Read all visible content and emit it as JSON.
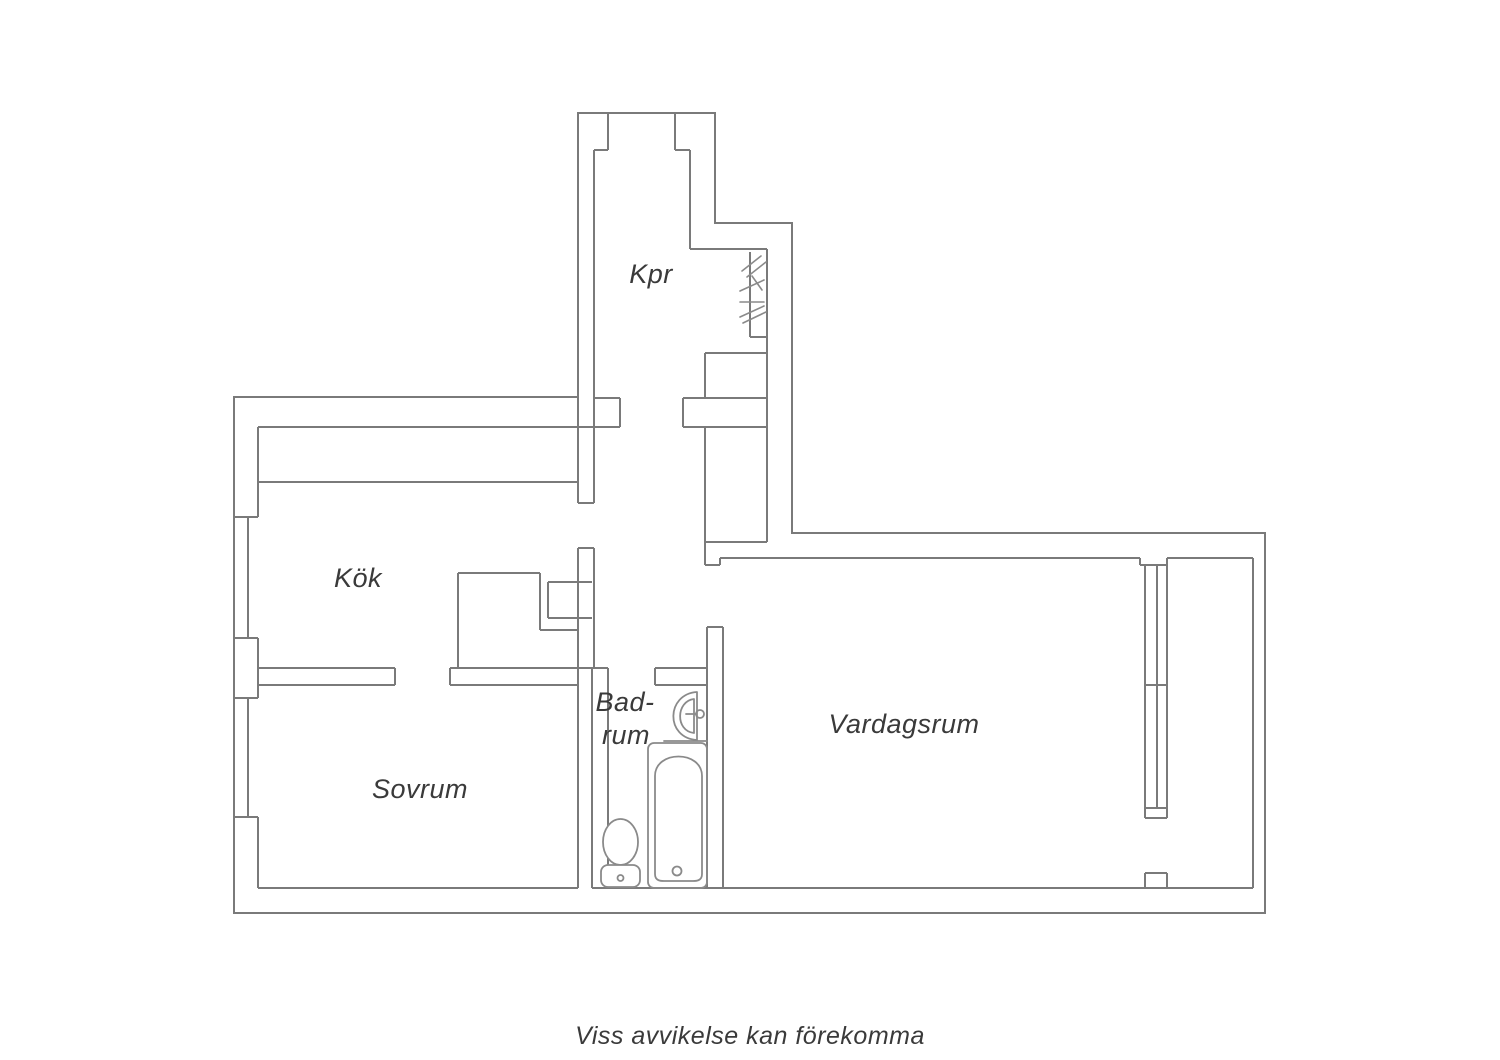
{
  "floorplan": {
    "caption": "Viss avvikelse kan förekomma",
    "rooms": {
      "kpr": {
        "label": "Kpr"
      },
      "kok": {
        "label": "Kök"
      },
      "sovrum": {
        "label": "Sovrum"
      },
      "badrum": {
        "label_line1": "Bad-",
        "label_line2": "rum"
      },
      "vardagsrum": {
        "label": "Vardagsrum"
      }
    },
    "fixtures": {
      "bathroom": [
        "sink",
        "bathtub",
        "toilet"
      ],
      "hall": [
        "wardrobe-hatch"
      ],
      "windows": [
        "kitchen-window",
        "bedroom-window",
        "livingroom-window"
      ]
    },
    "colors": {
      "wall_line": "#7a7a7a",
      "fixture_line": "#8a8a8a",
      "text": "#3a3a3a",
      "background": "#ffffff"
    }
  }
}
